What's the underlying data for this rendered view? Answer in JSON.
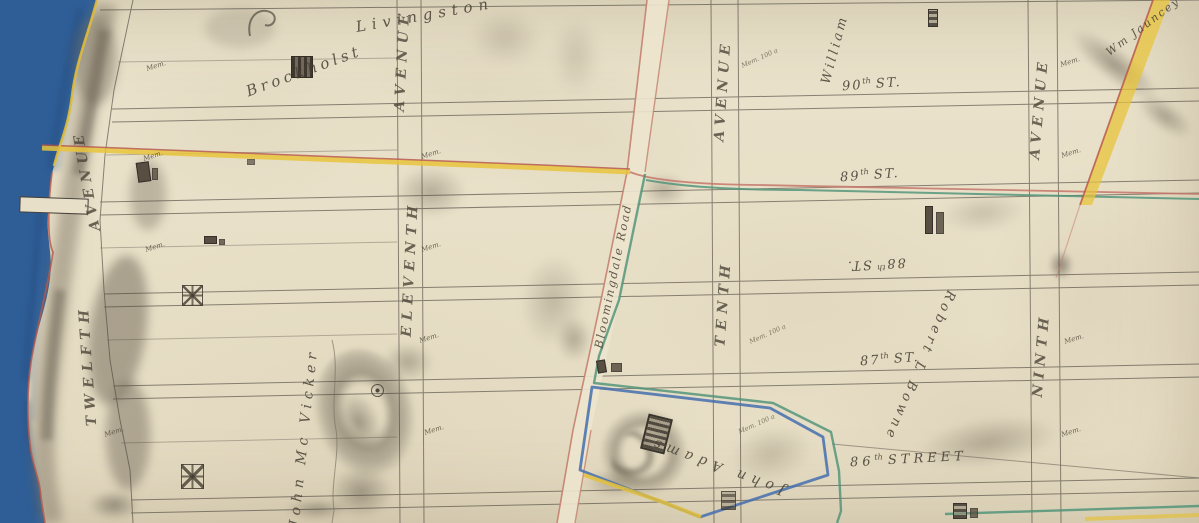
{
  "map": {
    "owners": {
      "brockholst": "Brockholst",
      "livingston": "Livingston",
      "william": "William",
      "wm_jauncey": "Wm Jauncey",
      "john_mcvicker": "John Mc Vicker",
      "robert_bowne": "Robert L Bowne",
      "john_adams": "John Adams"
    },
    "avenues": [
      {
        "name": "TWELFTH",
        "word": "AVENUE"
      },
      {
        "name": "ELEVENTH",
        "word": "AVENUE"
      },
      {
        "name": "TENTH",
        "word": "AVENUE"
      },
      {
        "name": "NINTH",
        "word": "AVENUE"
      }
    ],
    "streets": [
      {
        "num": "90",
        "sup": "th",
        "word": "ST."
      },
      {
        "num": "89",
        "sup": "th",
        "word": "ST."
      },
      {
        "num": "88",
        "sup": "th",
        "word": "ST."
      },
      {
        "num": "87",
        "sup": "th",
        "word": "ST."
      },
      {
        "num": "86",
        "sup": "th",
        "word": "STREET"
      }
    ],
    "roads": {
      "bloomingdale": "Bloomingdale Road"
    },
    "annotations": {
      "mem": "Mem.",
      "micro": "Mem. 100 a"
    },
    "colors": {
      "water": "#2f5e97",
      "paper": "#e9e0c9",
      "road_yellow": "#e8c43c",
      "road_pink": "#c47f6f",
      "boundary_green": "#4a9177",
      "boundary_blue": "#446fae",
      "ink": "#46413a"
    }
  }
}
